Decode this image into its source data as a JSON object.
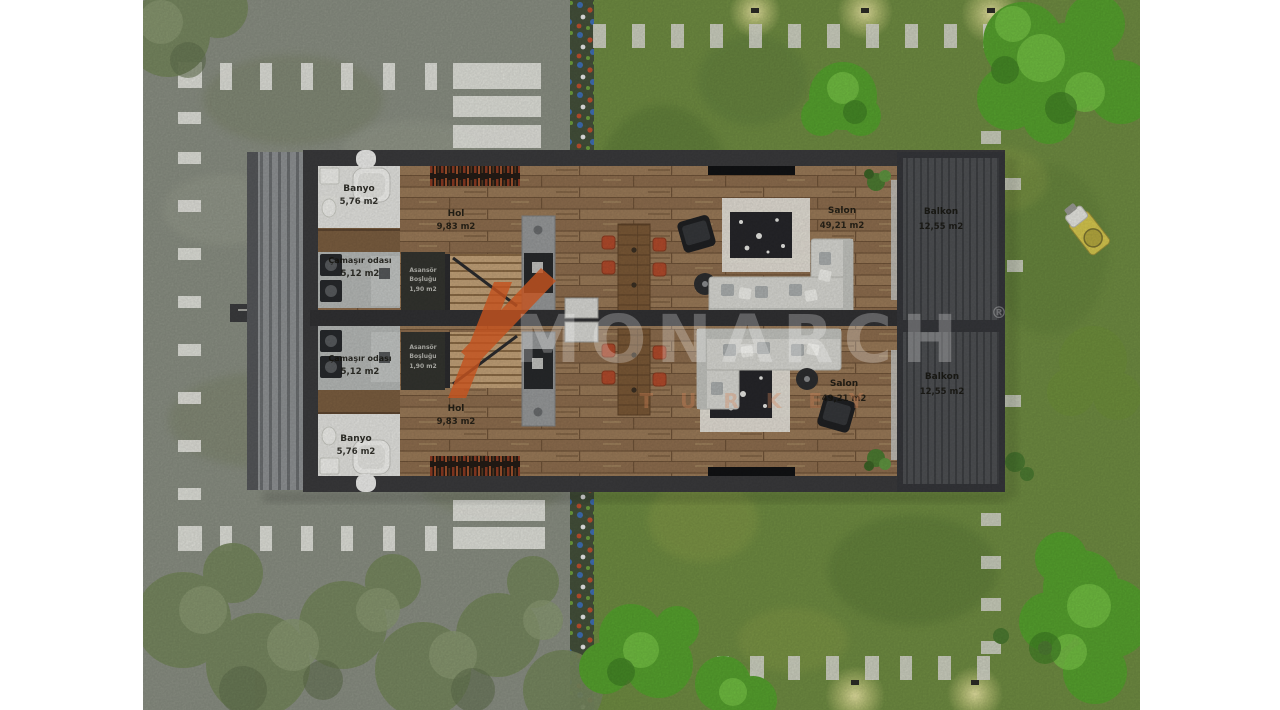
{
  "scene": {
    "type": "architectural top-view site / floor plan rendering",
    "description": "Mirrored twin duplex villa plan with parking lot on the left and landscaped lawn on the right"
  },
  "watermark": {
    "brand": "MONARCH",
    "registered": "®",
    "country": "TURKEY",
    "accent_color": "#c4531f"
  },
  "units": [
    {
      "name": "upper-unit",
      "rooms": [
        {
          "name": "Banyo",
          "area": "5,76 m2"
        },
        {
          "name": "Çamaşır odası",
          "area": "5,12 m2"
        },
        {
          "name": "Hol",
          "area": "9,83 m2"
        },
        {
          "name_line1": "Asansör",
          "name_line2": "Boşluğu",
          "area": "1,90 m2"
        },
        {
          "name": "Salon",
          "area": "49,21 m2"
        },
        {
          "name": "Balkon",
          "area": "12,55 m2"
        }
      ]
    },
    {
      "name": "lower-unit",
      "rooms": [
        {
          "name": "Banyo",
          "area": "5,76 m2"
        },
        {
          "name": "Çamaşır odası",
          "area": "5,12 m2"
        },
        {
          "name": "Hol",
          "area": "9,83 m2"
        },
        {
          "name_line1": "Asansör",
          "name_line2": "Boşluğu",
          "area": "1,90 m2"
        },
        {
          "name": "Salon",
          "area": "49,21 m2"
        },
        {
          "name": "Balkon",
          "area": "12,55 m2"
        }
      ]
    }
  ],
  "palette": {
    "grass": "#6f8c42",
    "asphalt": "#8a8f83",
    "wood_floor": "#9a7a58",
    "deck": "#4e5053",
    "wall": "#3a3a3c",
    "chair_accent": "#b14a2b"
  }
}
